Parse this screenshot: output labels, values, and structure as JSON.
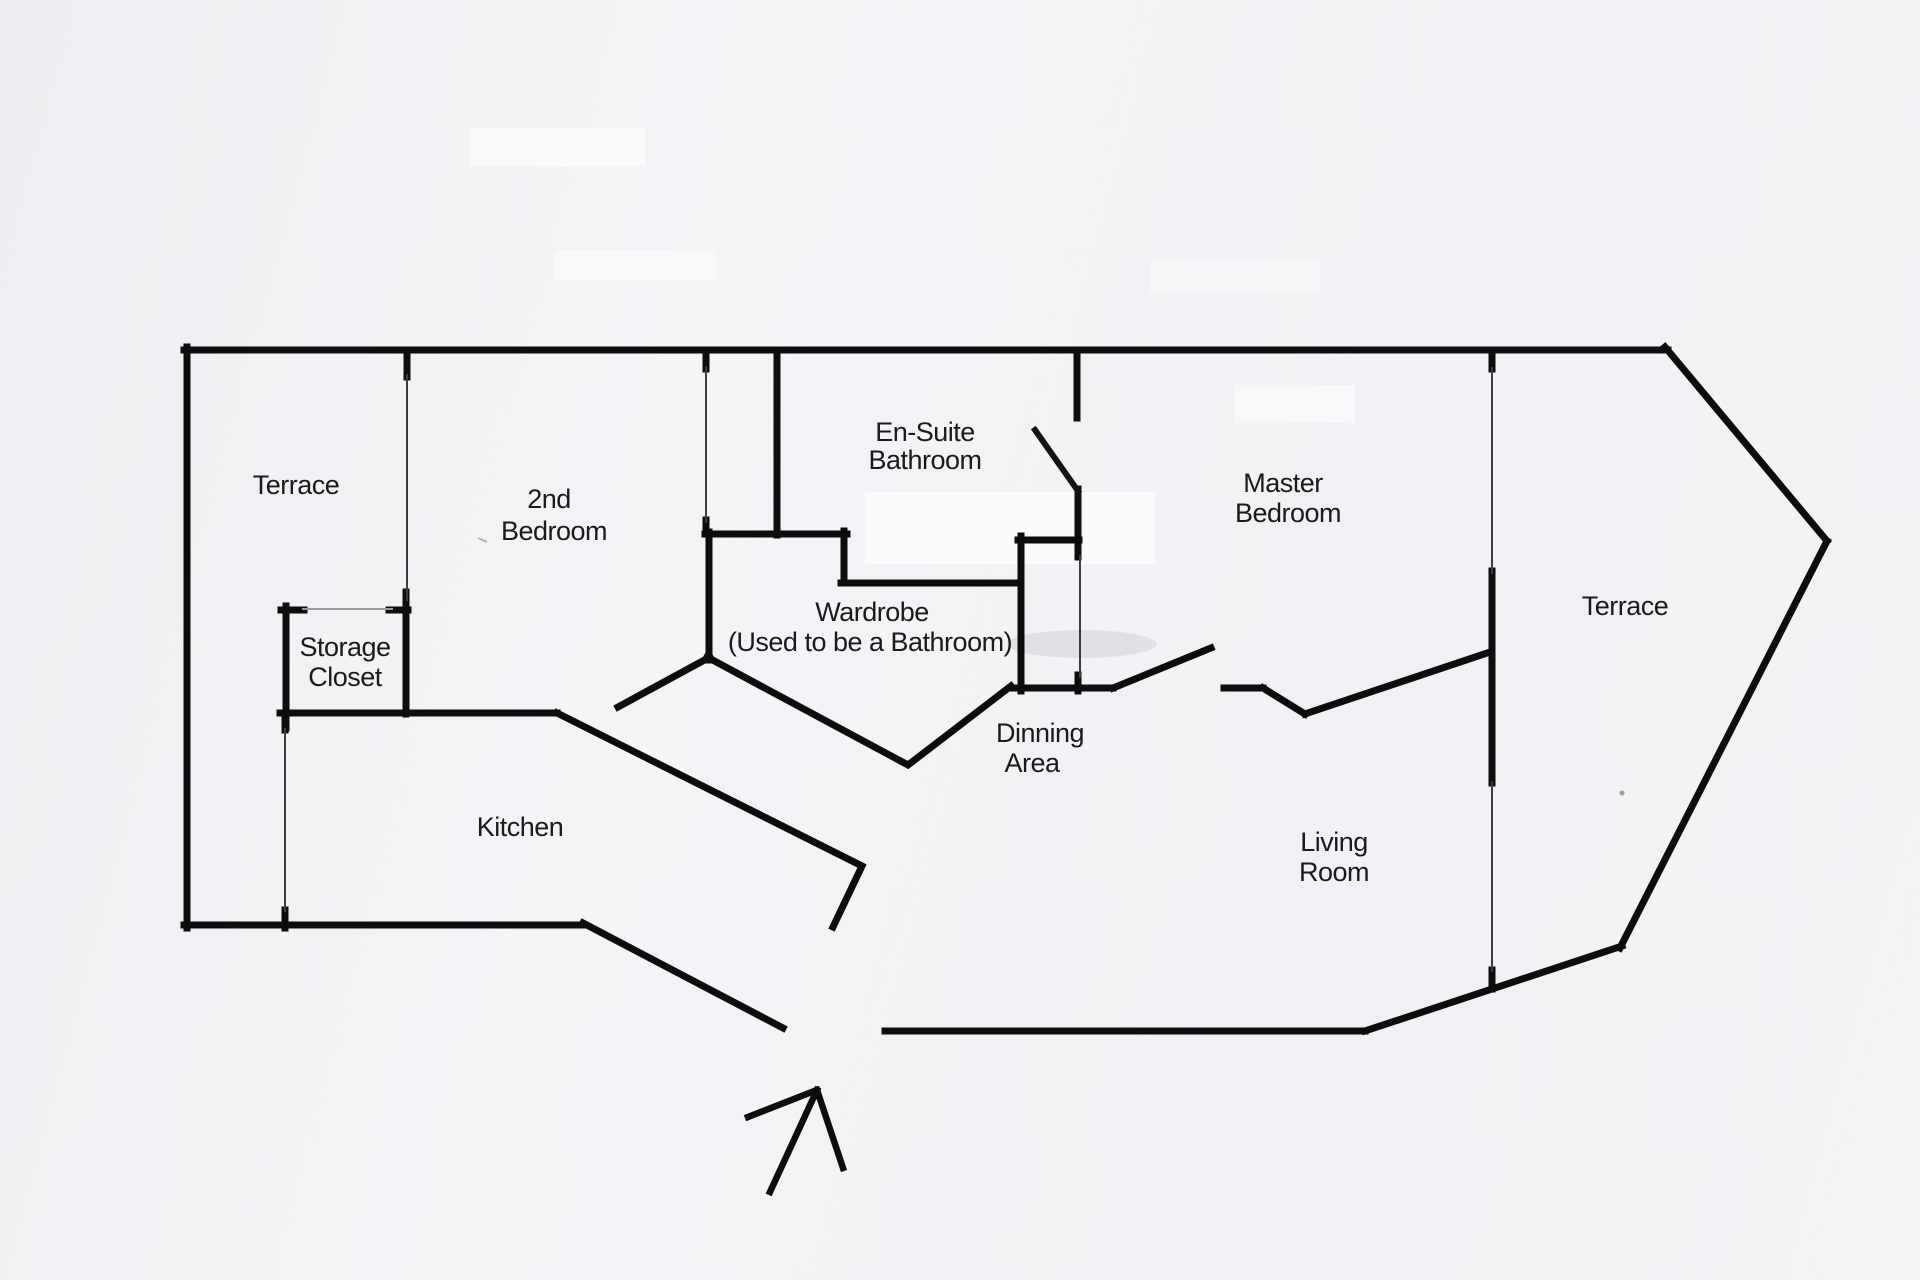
{
  "rooms": {
    "terrace_left": {
      "label": "Terrace"
    },
    "second_bedroom": {
      "line1": "2nd",
      "line2": "Bedroom"
    },
    "ensuite_bathroom": {
      "line1": "En-Suite",
      "line2": "Bathroom"
    },
    "master_bedroom": {
      "line1": "Master",
      "line2": "Bedroom"
    },
    "terrace_right": {
      "label": "Terrace"
    },
    "storage_closet": {
      "line1": "Storage",
      "line2": "Closet"
    },
    "wardrobe": {
      "line1": "Wardrobe",
      "line2": "(Used to be a Bathroom)"
    },
    "dining_area": {
      "line1": "Dinning",
      "line2": "Area"
    },
    "kitchen": {
      "label": "Kitchen"
    },
    "living_room": {
      "line1": "Living",
      "line2": "Room"
    }
  },
  "icons": {
    "entrance_arrow": "entrance-direction-arrow"
  },
  "colors": {
    "paper": "#f2f1f4",
    "wall": "#0d0d0d",
    "text": "#1a1a1a"
  }
}
